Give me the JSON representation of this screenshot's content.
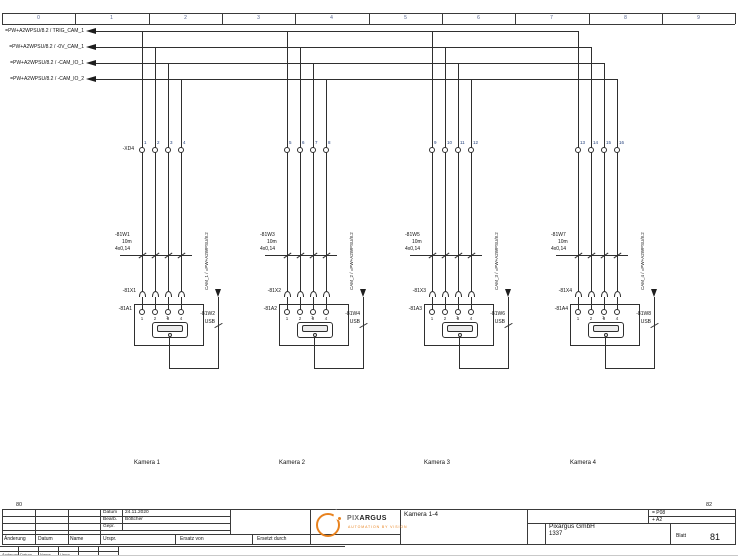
{
  "frame": {
    "column_labels": [
      "0",
      "1",
      "2",
      "3",
      "4",
      "5",
      "6",
      "7",
      "8",
      "9"
    ],
    "prev_page": "80",
    "next_page": "82"
  },
  "signals": [
    {
      "label": "=PW+A2WPSU/8.2 / TRIG_CAM_1"
    },
    {
      "label": "=PW+A2WPSU/8.2 / -0V_CAM_1"
    },
    {
      "label": "=PW+A2WPSU/8.2 / -CAM_IO_1"
    },
    {
      "label": "=PW+A2WPSU/8.2 / -CAM_IO_2"
    }
  ],
  "terminal_strip": "-XD4",
  "cameras": [
    {
      "title": "Kamera 1",
      "cable": "-81W1",
      "cable_length": "10m",
      "cable_spec": "4x0,14",
      "connector": "-81X1",
      "device": "-81A1",
      "usb_cable": "-81W2",
      "usb_type": "USB",
      "usb_port": "1",
      "usb_ref": "CAM_1 / =PW+A2WPSU/8.2",
      "terminals": [
        "1",
        "2",
        "3",
        "4"
      ],
      "pins": [
        "1",
        "2",
        "3",
        "4"
      ]
    },
    {
      "title": "Kamera 2",
      "cable": "-81W3",
      "cable_length": "10m",
      "cable_spec": "4x0,14",
      "connector": "-81X2",
      "device": "-81A2",
      "usb_cable": "-81W4",
      "usb_type": "USB",
      "usb_port": "1",
      "usb_ref": "CAM_2 / =PW+A2WPSU/8.2",
      "terminals": [
        "5",
        "6",
        "7",
        "8"
      ],
      "pins": [
        "1",
        "2",
        "3",
        "4"
      ]
    },
    {
      "title": "Kamera 3",
      "cable": "-81W5",
      "cable_length": "10m",
      "cable_spec": "4x0,14",
      "connector": "-81X3",
      "device": "-81A3",
      "usb_cable": "-81W6",
      "usb_type": "USB",
      "usb_port": "1",
      "usb_ref": "CAM_3 / =PW+A2WPSU/8.2",
      "terminals": [
        "9",
        "10",
        "11",
        "12"
      ],
      "pins": [
        "1",
        "2",
        "3",
        "4"
      ]
    },
    {
      "title": "Kamera 4",
      "cable": "-81W7",
      "cable_length": "10m",
      "cable_spec": "4x0,14",
      "connector": "-81X4",
      "device": "-81A4",
      "usb_cable": "-81W8",
      "usb_type": "USB",
      "usb_port": "1",
      "usb_ref": "CAM_4 / =PW+A2WPSU/8.2",
      "terminals": [
        "13",
        "14",
        "15",
        "16"
      ],
      "pins": [
        "1",
        "2",
        "3",
        "4"
      ]
    }
  ],
  "title_block": {
    "revision_labels": {
      "aenderung": "Änderung",
      "datum": "Datum",
      "name": "Name",
      "urspr": "Urspr.",
      "ersatz_von": "Ersatz von",
      "ersetzt_durch": "Ersetzt durch"
    },
    "info_labels": {
      "datum": "Datum",
      "bearb": "Bearb.",
      "gepr": "Gepr.",
      "blatt": "Blatt"
    },
    "datum_value": "24.11.2020",
    "bearb_value": "Böttcher",
    "drawing_title": "Kamera 1-4",
    "company": "Pixargus GmbH",
    "project_number": "1337",
    "sheet_number": "81",
    "plant_ref": "= P08",
    "location_ref": "+ A2",
    "logo": {
      "name_pix": "PIX",
      "name_argus": "ARGUS",
      "tagline": "AUTOMATION BY VISION"
    }
  },
  "colors": {
    "line": "#2f2f2f",
    "accent_orange": "#e8821e",
    "tiny_blue": "#1f3d7a"
  }
}
